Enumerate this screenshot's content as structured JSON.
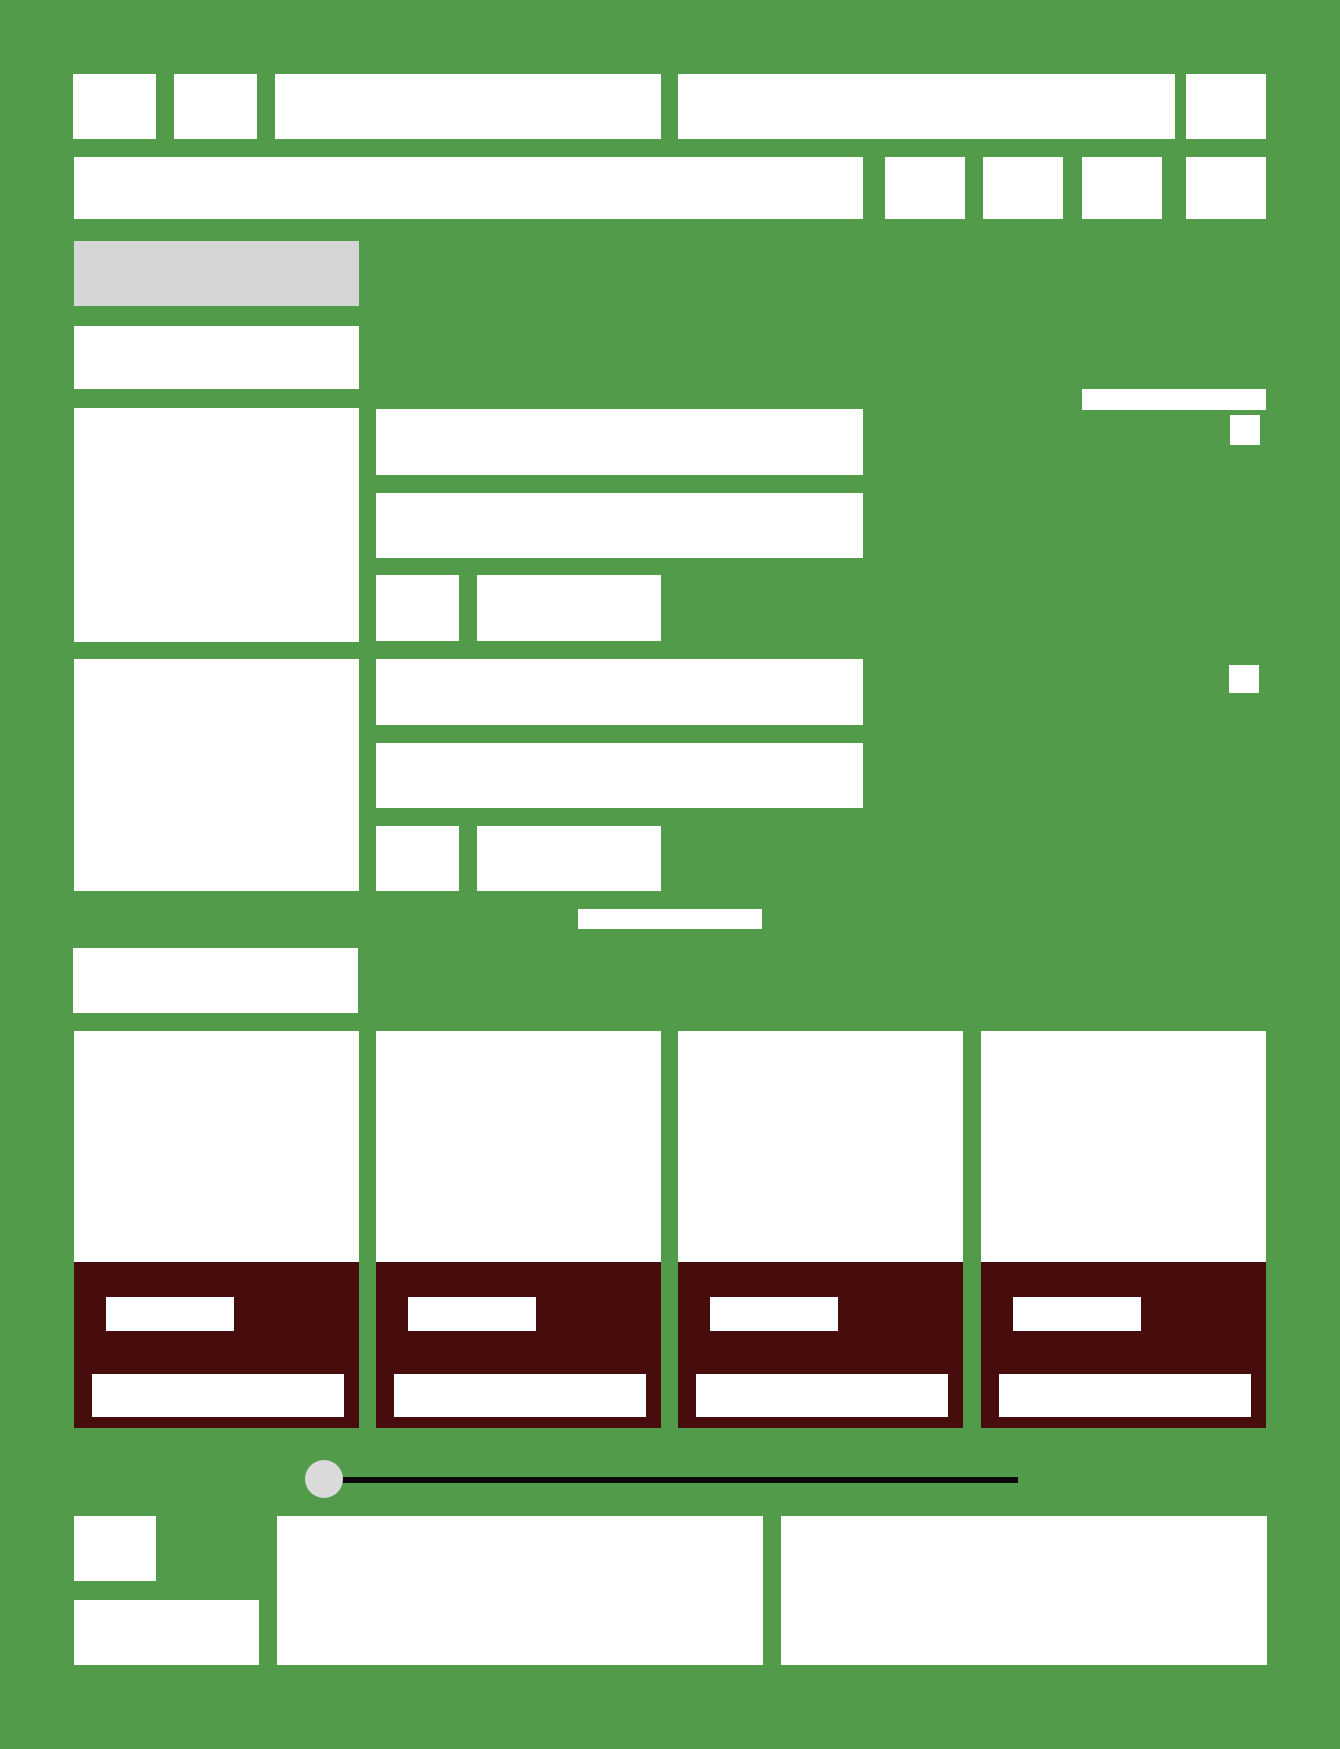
{
  "canvas": {
    "width": 1340,
    "height": 1749,
    "background": "#529B4B"
  },
  "colors": {
    "panel": "#FFFFFF",
    "muted": "#D6D6D6",
    "card_footer": "#470D0D",
    "slider_track": "#0A0A0A",
    "slider_knob": "#DADADA"
  },
  "rects": [
    {
      "name": "toolbar-button-1",
      "x": 73,
      "y": 74,
      "w": 83,
      "h": 65,
      "fill": "panel",
      "interactable": true
    },
    {
      "name": "toolbar-button-2",
      "x": 174,
      "y": 74,
      "w": 83,
      "h": 65,
      "fill": "panel",
      "interactable": true
    },
    {
      "name": "toolbar-field-left",
      "x": 275,
      "y": 74,
      "w": 386,
      "h": 65,
      "fill": "panel",
      "interactable": true
    },
    {
      "name": "toolbar-field-right",
      "x": 678,
      "y": 74,
      "w": 497,
      "h": 65,
      "fill": "panel",
      "interactable": true
    },
    {
      "name": "toolbar-button-3",
      "x": 1186,
      "y": 74,
      "w": 80,
      "h": 65,
      "fill": "panel",
      "interactable": true
    },
    {
      "name": "search-input",
      "x": 74,
      "y": 157,
      "w": 789,
      "h": 62,
      "fill": "panel",
      "interactable": true
    },
    {
      "name": "filter-button-1",
      "x": 885,
      "y": 157,
      "w": 80,
      "h": 62,
      "fill": "panel",
      "interactable": true
    },
    {
      "name": "filter-button-2",
      "x": 983,
      "y": 157,
      "w": 80,
      "h": 62,
      "fill": "panel",
      "interactable": true
    },
    {
      "name": "filter-button-3",
      "x": 1082,
      "y": 157,
      "w": 80,
      "h": 62,
      "fill": "panel",
      "interactable": true
    },
    {
      "name": "filter-button-4",
      "x": 1186,
      "y": 157,
      "w": 80,
      "h": 62,
      "fill": "panel",
      "interactable": true
    },
    {
      "name": "section-title-muted",
      "x": 74,
      "y": 241,
      "w": 285,
      "h": 65,
      "fill": "muted",
      "interactable": false
    },
    {
      "name": "form-section-label",
      "x": 74,
      "y": 326,
      "w": 285,
      "h": 63,
      "fill": "panel",
      "interactable": false
    },
    {
      "name": "fieldset-a-label-panel",
      "x": 74,
      "y": 408,
      "w": 285,
      "h": 234,
      "fill": "panel",
      "interactable": false
    },
    {
      "name": "fieldset-a-input-1",
      "x": 376,
      "y": 409,
      "w": 487,
      "h": 66,
      "fill": "panel",
      "interactable": true
    },
    {
      "name": "fieldset-a-input-2",
      "x": 376,
      "y": 493,
      "w": 487,
      "h": 65,
      "fill": "panel",
      "interactable": true
    },
    {
      "name": "fieldset-a-input-small",
      "x": 376,
      "y": 575,
      "w": 83,
      "h": 66,
      "fill": "panel",
      "interactable": true
    },
    {
      "name": "fieldset-a-input-medium",
      "x": 477,
      "y": 575,
      "w": 184,
      "h": 66,
      "fill": "panel",
      "interactable": true
    },
    {
      "name": "side-accent-bar",
      "x": 1082,
      "y": 389,
      "w": 184,
      "h": 21,
      "fill": "panel",
      "interactable": false
    },
    {
      "name": "side-checkbox-1",
      "x": 1230,
      "y": 415,
      "w": 30,
      "h": 30,
      "fill": "panel",
      "interactable": true
    },
    {
      "name": "side-checkbox-2",
      "x": 1229,
      "y": 665,
      "w": 30,
      "h": 28,
      "fill": "panel",
      "interactable": true
    },
    {
      "name": "fieldset-b-label-panel",
      "x": 74,
      "y": 659,
      "w": 285,
      "h": 232,
      "fill": "panel",
      "interactable": false
    },
    {
      "name": "fieldset-b-input-1",
      "x": 376,
      "y": 659,
      "w": 487,
      "h": 66,
      "fill": "panel",
      "interactable": true
    },
    {
      "name": "fieldset-b-input-2",
      "x": 376,
      "y": 743,
      "w": 487,
      "h": 65,
      "fill": "panel",
      "interactable": true
    },
    {
      "name": "fieldset-b-input-small",
      "x": 376,
      "y": 826,
      "w": 83,
      "h": 65,
      "fill": "panel",
      "interactable": true
    },
    {
      "name": "fieldset-b-input-medium",
      "x": 477,
      "y": 826,
      "w": 184,
      "h": 65,
      "fill": "panel",
      "interactable": true
    },
    {
      "name": "center-divider-bar",
      "x": 578,
      "y": 909,
      "w": 184,
      "h": 20,
      "fill": "panel",
      "interactable": false
    },
    {
      "name": "grid-section-label",
      "x": 73,
      "y": 948,
      "w": 285,
      "h": 65,
      "fill": "panel",
      "interactable": false
    },
    {
      "name": "card-1-image",
      "x": 74,
      "y": 1031,
      "w": 285,
      "h": 231,
      "fill": "panel",
      "interactable": true
    },
    {
      "name": "card-1-footer",
      "x": 74,
      "y": 1262,
      "w": 285,
      "h": 166,
      "fill": "card_footer",
      "interactable": false
    },
    {
      "name": "card-1-price-button",
      "x": 106,
      "y": 1297,
      "w": 128,
      "h": 34,
      "fill": "panel",
      "interactable": true
    },
    {
      "name": "card-1-title-bar",
      "x": 92,
      "y": 1374,
      "w": 252,
      "h": 43,
      "fill": "panel",
      "interactable": true
    },
    {
      "name": "card-2-image",
      "x": 376,
      "y": 1031,
      "w": 285,
      "h": 231,
      "fill": "panel",
      "interactable": true
    },
    {
      "name": "card-2-footer",
      "x": 376,
      "y": 1262,
      "w": 285,
      "h": 166,
      "fill": "card_footer",
      "interactable": false
    },
    {
      "name": "card-2-price-button",
      "x": 408,
      "y": 1297,
      "w": 128,
      "h": 34,
      "fill": "panel",
      "interactable": true
    },
    {
      "name": "card-2-title-bar",
      "x": 394,
      "y": 1374,
      "w": 252,
      "h": 43,
      "fill": "panel",
      "interactable": true
    },
    {
      "name": "card-3-image",
      "x": 678,
      "y": 1031,
      "w": 285,
      "h": 231,
      "fill": "panel",
      "interactable": true
    },
    {
      "name": "card-3-footer",
      "x": 678,
      "y": 1262,
      "w": 285,
      "h": 166,
      "fill": "card_footer",
      "interactable": false
    },
    {
      "name": "card-3-price-button",
      "x": 710,
      "y": 1297,
      "w": 128,
      "h": 34,
      "fill": "panel",
      "interactable": true
    },
    {
      "name": "card-3-title-bar",
      "x": 696,
      "y": 1374,
      "w": 252,
      "h": 43,
      "fill": "panel",
      "interactable": true
    },
    {
      "name": "card-4-image",
      "x": 981,
      "y": 1031,
      "w": 285,
      "h": 231,
      "fill": "panel",
      "interactable": true
    },
    {
      "name": "card-4-footer",
      "x": 981,
      "y": 1262,
      "w": 285,
      "h": 166,
      "fill": "card_footer",
      "interactable": false
    },
    {
      "name": "card-4-price-button",
      "x": 1013,
      "y": 1297,
      "w": 128,
      "h": 34,
      "fill": "panel",
      "interactable": true
    },
    {
      "name": "card-4-title-bar",
      "x": 999,
      "y": 1374,
      "w": 252,
      "h": 43,
      "fill": "panel",
      "interactable": true
    },
    {
      "name": "slider-track",
      "x": 324,
      "y": 1477,
      "w": 694,
      "h": 6,
      "fill": "slider_track",
      "interactable": true
    },
    {
      "name": "slider-knob",
      "x": 305,
      "y": 1460,
      "w": 38,
      "h": 38,
      "fill": "slider_knob",
      "interactable": true,
      "round": "50%"
    },
    {
      "name": "footer-checkbox",
      "x": 74,
      "y": 1516,
      "w": 82,
      "h": 65,
      "fill": "panel",
      "interactable": true
    },
    {
      "name": "footer-label",
      "x": 74,
      "y": 1600,
      "w": 185,
      "h": 65,
      "fill": "panel",
      "interactable": false
    },
    {
      "name": "footer-panel-left",
      "x": 277,
      "y": 1516,
      "w": 486,
      "h": 149,
      "fill": "panel",
      "interactable": false
    },
    {
      "name": "footer-panel-right",
      "x": 781,
      "y": 1516,
      "w": 486,
      "h": 149,
      "fill": "panel",
      "interactable": false
    }
  ]
}
